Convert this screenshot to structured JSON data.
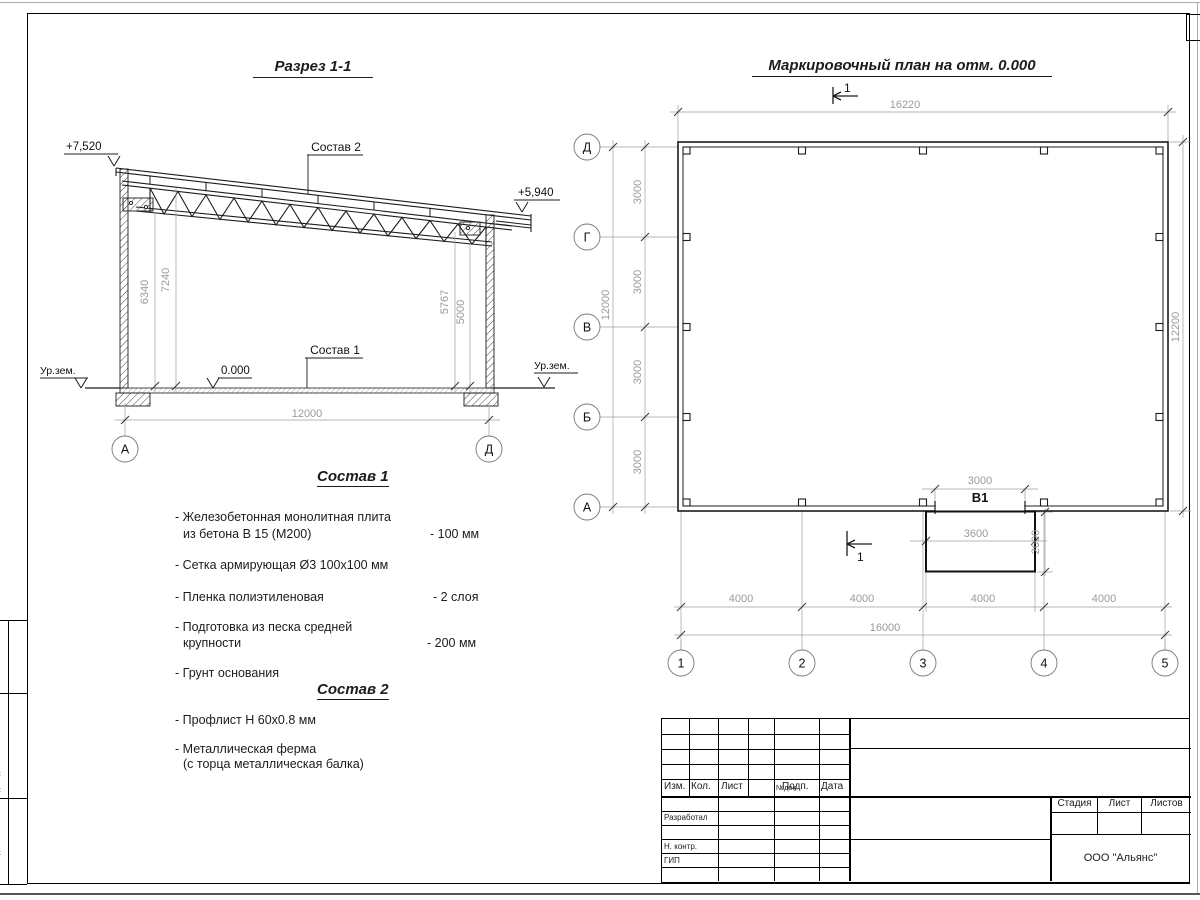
{
  "sheet": {
    "company": "ООО \"Альянс\"",
    "stage_label": "Стадия",
    "sheet_label": "Лист",
    "sheets_label": "Листов",
    "rev_columns": [
      "Изм.",
      "Кол.",
      "Лист",
      "№док.",
      "Подп.",
      "Дата"
    ],
    "roles": [
      "Разработал",
      "Н. контр.",
      "ГИП"
    ],
    "side_labels": [
      "Взам. инв. №",
      "Подп. и дата",
      "Инв. № подл."
    ]
  },
  "section": {
    "title": "Разрез 1-1",
    "elev_left": "+7,520",
    "elev_right": "+5,940",
    "level_zero": "0.000",
    "ground_left": "Ур.зем.",
    "ground_right": "Ур.зем.",
    "dims": {
      "h1": "6340",
      "h2": "7240",
      "h3": "5767",
      "h4": "5000",
      "span": "12000"
    },
    "axes": {
      "left": "А",
      "right": "Д"
    },
    "callout_roof": "Состав 2",
    "callout_floor": "Состав 1"
  },
  "notes": {
    "comp1_title": "Состав 1",
    "comp1": [
      {
        "l1": "- Железобетонная  монолитная плита",
        "l2": "из бетона В 15 (М200)",
        "val": "- 100 мм"
      },
      {
        "l1": "- Сетка армирующая Ø3 100х100 мм",
        "l2": "",
        "val": ""
      },
      {
        "l1": "- Пленка полиэтиленовая",
        "l2": "",
        "val": "-  2 слоя"
      },
      {
        "l1": "- Подготовка из песка средней",
        "l2": "крупности",
        "val": "- 200 мм"
      },
      {
        "l1": "- Грунт основания",
        "l2": "",
        "val": ""
      }
    ],
    "comp2_title": "Состав 2",
    "comp2": [
      {
        "l1": "- Профлист Н 60х0.8 мм",
        "l2": "",
        "val": ""
      },
      {
        "l1": "- Металлическая ферма",
        "l2": "(с торца металлическая балка)",
        "val": ""
      }
    ]
  },
  "plan": {
    "title": "Маркировочный план на отм. 0.000",
    "cut_mark": "1",
    "row_axes": [
      "Д",
      "Г",
      "В",
      "Б",
      "А"
    ],
    "col_axes": [
      "1",
      "2",
      "3",
      "4",
      "5"
    ],
    "opening_label": "В1",
    "dims": {
      "top_total": "16220",
      "right_total": "12200",
      "left_total": "12000",
      "left_bay": "3000",
      "bottom_bay": "4000",
      "bottom_total": "16000",
      "opening": "3000",
      "ramp_width": "3600",
      "ramp_depth": "2000"
    }
  }
}
